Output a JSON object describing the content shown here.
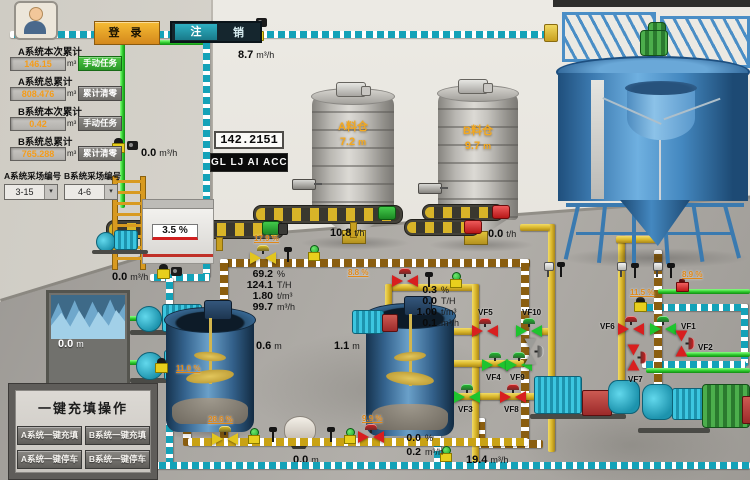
{
  "header": {
    "login": "登 录",
    "logout_left": "注",
    "logout_right": "销"
  },
  "icons": {
    "dropdown_arrow": "▾"
  },
  "left_panel": {
    "rows": [
      {
        "label": "A系统本次累计",
        "value": "146.15",
        "unit": "m³",
        "button": "手动任务"
      },
      {
        "label": "A系统总累计",
        "value": "808.476",
        "unit": "m³",
        "button": "累计清零"
      },
      {
        "label": "B系统本次累计",
        "value": "0.42",
        "unit": "m³",
        "button": "手动任务"
      },
      {
        "label": "B系统总累计",
        "value": "765.288",
        "unit": "m³",
        "button": "累计清零"
      }
    ],
    "selectors": [
      {
        "label": "A系统采场编号",
        "value": "3-15"
      },
      {
        "label": "B系统采场编号",
        "value": "4-6"
      }
    ]
  },
  "displays": {
    "accumulator": "142.2151",
    "ticker": "GL LJ AI ACC"
  },
  "flows": {
    "top": {
      "value": "8.7",
      "unit": "m³/h"
    },
    "wall": {
      "value": "0.0",
      "unit": "m³/h"
    },
    "tank_out": {
      "value": "0.0",
      "unit": "m³/h"
    },
    "bottom": {
      "value": "19.4",
      "unit": "m³/h"
    },
    "conveyor_a": {
      "value": "10.8",
      "unit": "t/h"
    },
    "conveyor_b": {
      "value": "0.0",
      "unit": "t/h"
    }
  },
  "equipment": {
    "flocc": {
      "value": "3.5",
      "unit": "%"
    },
    "silo_a": {
      "name": "A料仓",
      "level": "7.2",
      "unit": "m"
    },
    "silo_b": {
      "name": "B料仓",
      "level": "9.7",
      "unit": "m"
    },
    "mix1": {
      "value": "0.6",
      "unit": "m"
    },
    "mix2": {
      "value": "1.1",
      "unit": "m"
    },
    "water": {
      "value": "0.0",
      "unit": "m"
    },
    "hopper": {
      "value": "0.0",
      "unit": "m"
    }
  },
  "groups": {
    "a": [
      {
        "value": "69.2",
        "unit": "%"
      },
      {
        "value": "124.1",
        "unit": "T/H"
      },
      {
        "value": "1.80",
        "unit": "t/m³"
      },
      {
        "value": "99.7",
        "unit": "m³/h"
      }
    ],
    "b": [
      {
        "value": "0.3",
        "unit": "%"
      },
      {
        "value": "0.0",
        "unit": "T/H"
      },
      {
        "value": "1.00",
        "unit": "t/m³"
      },
      {
        "value": "0.1",
        "unit": "m³/h"
      }
    ],
    "c": [
      {
        "value": "0.0",
        "unit": "%"
      },
      {
        "value": "0.2",
        "unit": "m³/h"
      }
    ]
  },
  "pcts": {
    "feed_valve": "17.9 %",
    "mid_valve": "8.8 %",
    "fill_valve": "28.6 %",
    "tank2_valve": "9.9 %",
    "teal_line": "11.0 %",
    "right_upper": "11.5 %",
    "right_lower": "8.9 %"
  },
  "valves": {
    "vf1": {
      "label": "VF1",
      "state": "open"
    },
    "vf2": {
      "label": "VF2",
      "state": "closed"
    },
    "vf3": {
      "label": "VF3",
      "state": "open"
    },
    "vf4": {
      "label": "VF4",
      "state": "open"
    },
    "vf5": {
      "label": "VF5",
      "state": "closed"
    },
    "vf6": {
      "label": "VF6",
      "state": "closed"
    },
    "vf7": {
      "label": "VF7",
      "state": "closed"
    },
    "vf8": {
      "label": "VF8",
      "state": "closed"
    },
    "vf9": {
      "label": "VF9",
      "state": "open"
    },
    "vf10": {
      "label": "VF10",
      "state": "open"
    },
    "aux": {
      "label": "",
      "state": "off"
    }
  },
  "panel": {
    "title": "一键充填操作",
    "buttons": [
      "A系统一键充填",
      "B系统一键充填",
      "A系统一键停车",
      "B系统一键停车"
    ]
  }
}
